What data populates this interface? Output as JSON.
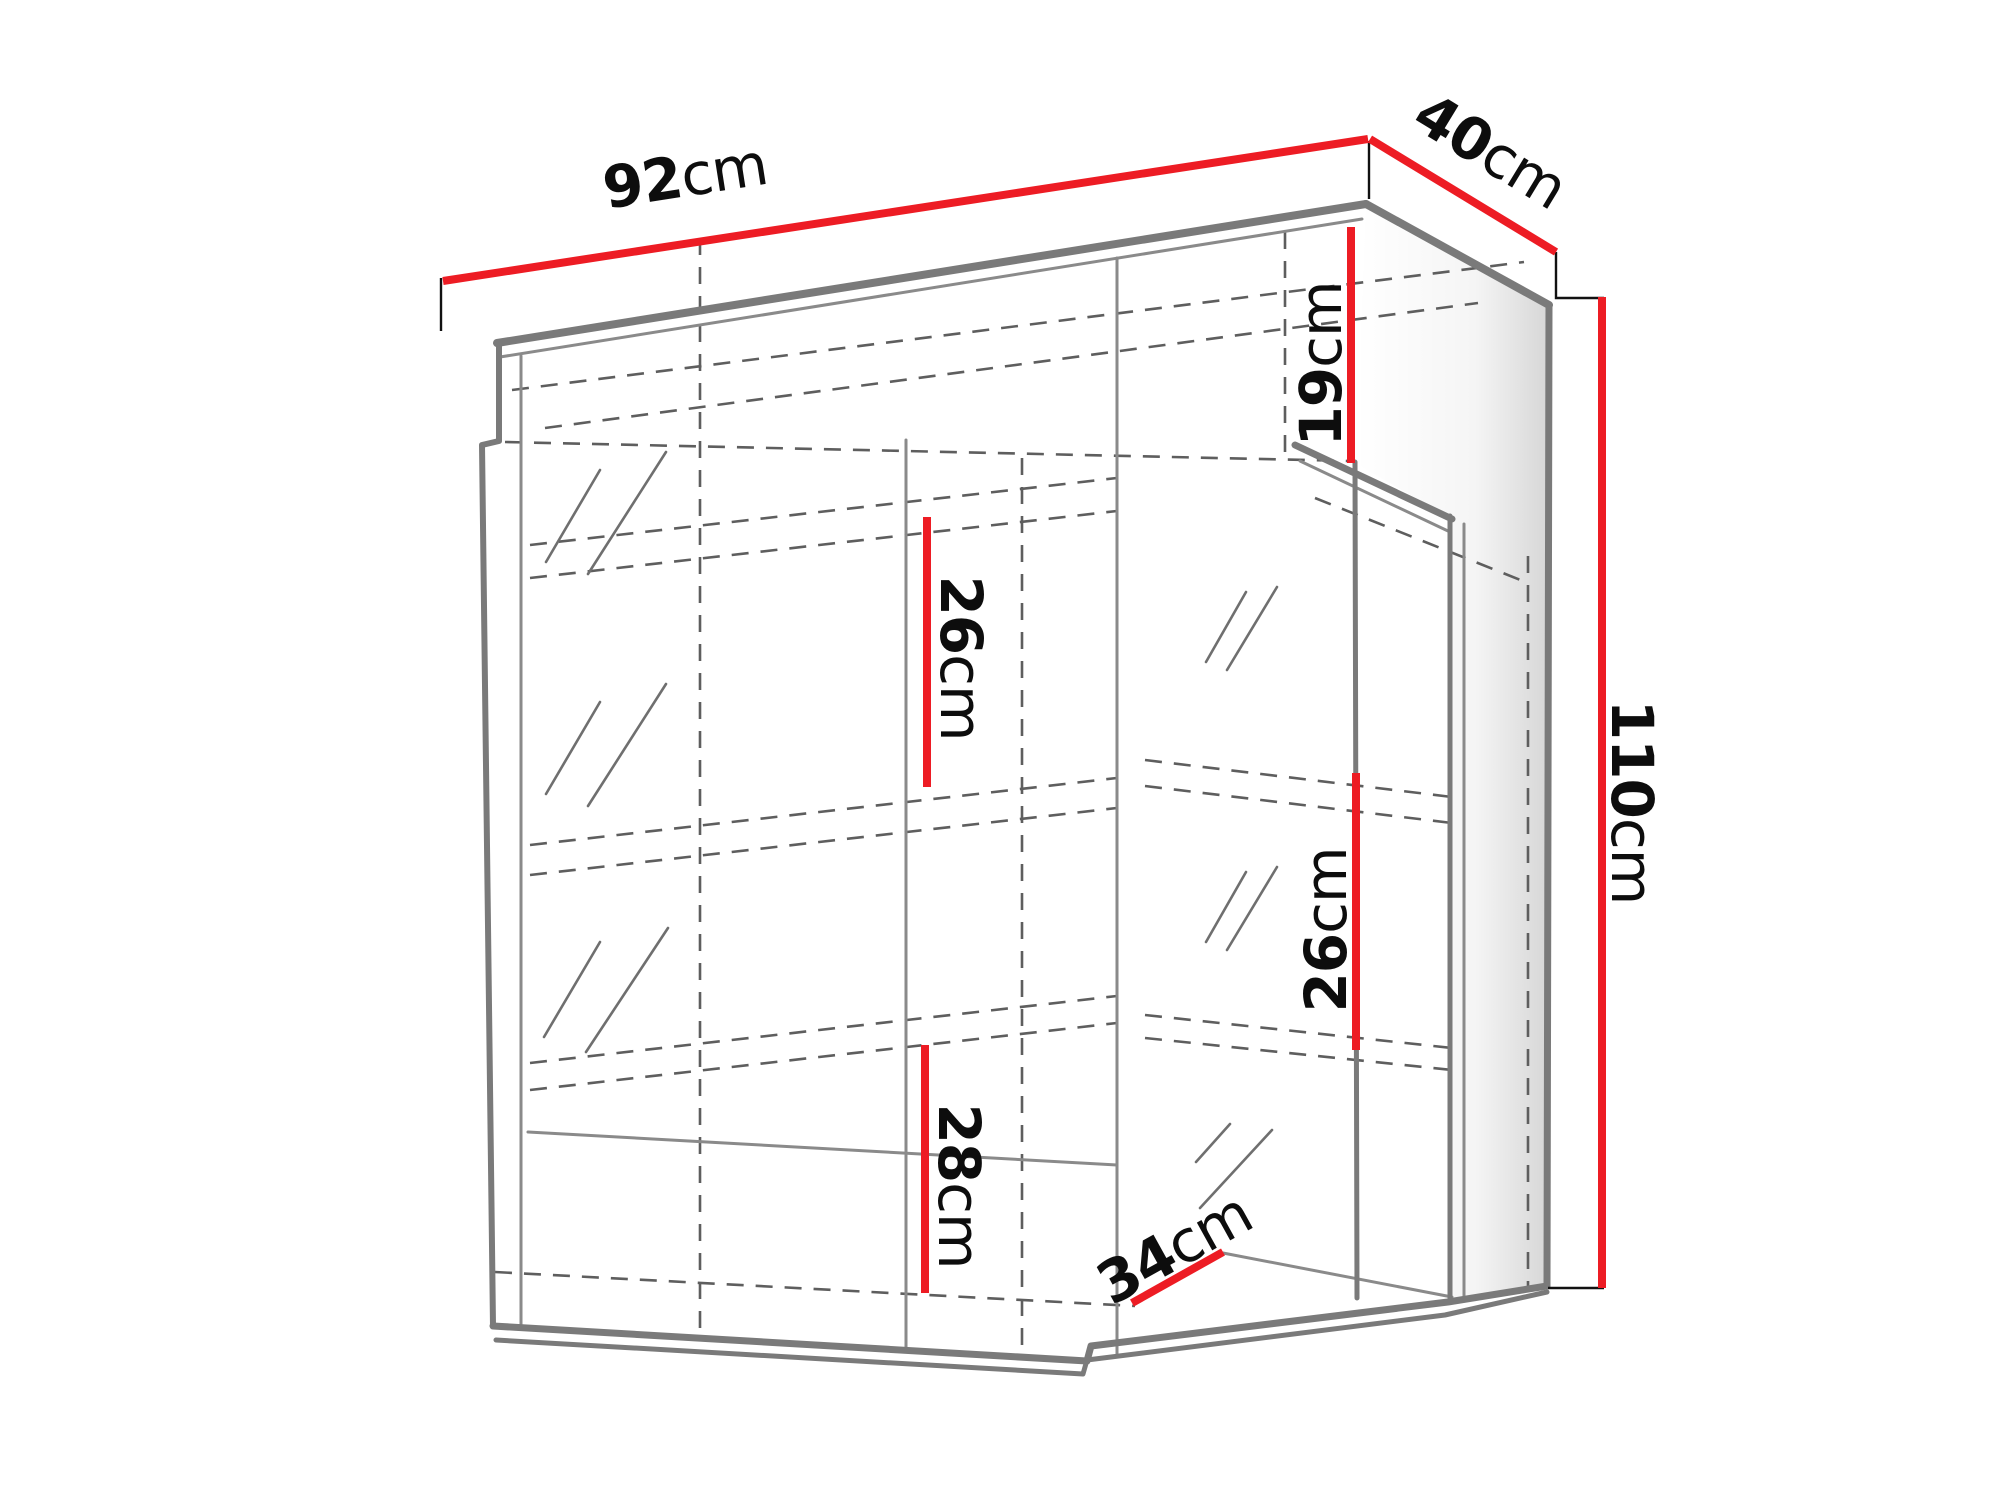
{
  "diagram": {
    "kind": "furniture-dimension-drawing",
    "subject": "wall display cabinet, perspective line drawing with glass doors and shelves",
    "background": "#ffffff",
    "colors": {
      "dimension_line": "#ed1c24",
      "label_text": "#0d0d0d",
      "outline_gray": "#7a7a7a",
      "hidden_line_gray": "#5e5e5e"
    },
    "dimensions": [
      {
        "id": "overall-width",
        "value": "92",
        "unit": "cm",
        "edge": "top front edge",
        "orientation": "diagonal-up-right"
      },
      {
        "id": "overall-depth",
        "value": "40",
        "unit": "cm",
        "edge": "top right edge",
        "orientation": "diagonal-down-right"
      },
      {
        "id": "overall-height",
        "value": "110",
        "unit": "cm",
        "edge": "right side full height",
        "orientation": "vertical"
      },
      {
        "id": "top-compartment-height",
        "value": "19",
        "unit": "cm",
        "edge": "upper open compartment",
        "orientation": "vertical"
      },
      {
        "id": "middle-shelf-gap",
        "value": "26",
        "unit": "cm",
        "edge": "middle section shelf gap",
        "orientation": "vertical"
      },
      {
        "id": "right-shelf-gap",
        "value": "26",
        "unit": "cm",
        "edge": "right section shelf gap",
        "orientation": "vertical"
      },
      {
        "id": "lower-shelf-gap",
        "value": "28",
        "unit": "cm",
        "edge": "lower middle shelf gap",
        "orientation": "vertical"
      },
      {
        "id": "bottom-shelf-depth",
        "value": "34",
        "unit": "cm",
        "edge": "bottom shelf depth",
        "orientation": "diagonal-up-right"
      }
    ]
  }
}
